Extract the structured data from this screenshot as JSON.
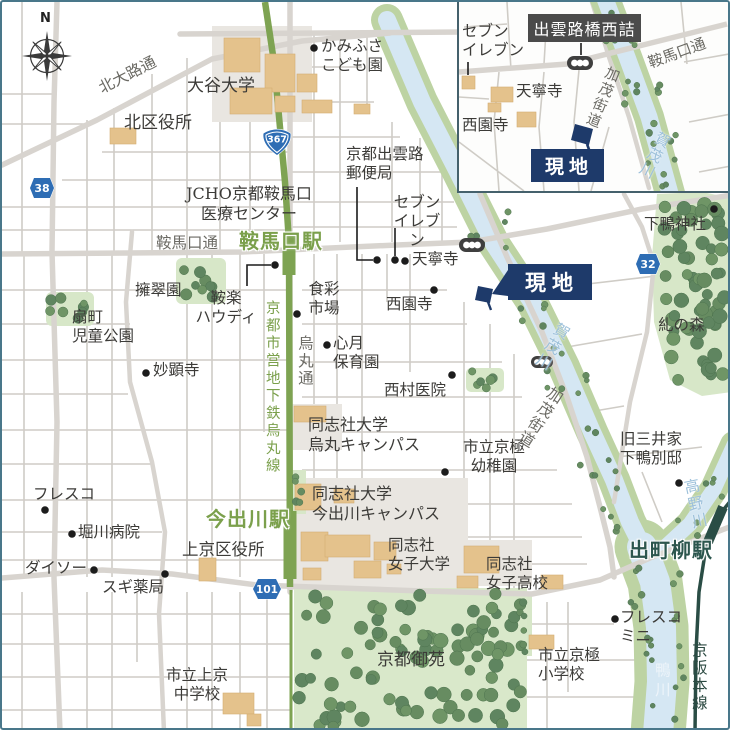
{
  "compass": {
    "north": "N"
  },
  "site": {
    "label": "現地"
  },
  "stations": {
    "kuramaguchi": "鞍馬口駅",
    "imadegawa": "今出川駅",
    "demachiyanagi": "出町柳駅"
  },
  "roads": {
    "kitaoji_dori": "北大路通",
    "kuramaguchi_dori": "鞍馬口通",
    "karasuma_dori": "烏丸通",
    "kamo_kaido": "加茂街道",
    "subway_line": "京都市営地下鉄烏丸線",
    "keihan_line": "京阪本線"
  },
  "rivers": {
    "kamogawa_upper": "賀茂川",
    "kamogawa": "鴨川",
    "takanogawa": "高野川"
  },
  "route_shields": {
    "r367": "367",
    "r38": "38",
    "r32": "32",
    "r101": "101"
  },
  "places": {
    "otani_university": "大谷大学",
    "kita_ward_office": "北区役所",
    "kamifusa_kodomoen": "かみふさ\nこども園",
    "jcho_medical_center": "JCHO京都鞍馬口\n医療センター",
    "izumoji_post_office": "京都出雲路\n郵便局",
    "seven_eleven": "セブン\nイレブン",
    "tenneiji": "天寧寺",
    "saionji": "西園寺",
    "shimogamo_shrine": "下鴨神社",
    "yosuien": "擁翠園",
    "kuraku_howdy": "鞍楽\nハウディ",
    "shokusai_ichiba": "食彩\n市場",
    "ogicho_park": "扇町\n児童公園",
    "shingetsu_hoikuen": "心月\n保育園",
    "nishimura_clinic": "西村医院",
    "myokenji": "妙顕寺",
    "doshisha_karasuma": "同志社大学\n烏丸キャンパス",
    "kyogoku_kindergarten": "市立京極\n幼稚園",
    "tadasu_no_mori": "糺の森",
    "mitsui_villa": "旧三井家\n下鴨別邸",
    "doshisha_imadegawa": "同志社大学\n今出川キャンパス",
    "fresco": "フレスコ",
    "horikawa_hospital": "堀川病院",
    "daiso": "ダイソー",
    "sugi_pharmacy": "スギ薬局",
    "kamigyo_ward_office": "上京区役所",
    "doshisha_womens_univ": "同志社\n女子大学",
    "doshisha_womens_hs": "同志社\n女子高校",
    "kyoto_gyoen": "京都御苑",
    "kamigyo_jhs": "市立上京\n中学校",
    "kyogoku_es": "市立京極\n小学校",
    "fresco_mini": "フレスコ\nミニ"
  },
  "inset": {
    "intersection_label": "出雲路橋西詰",
    "seven_eleven": "セブン\nイレブン",
    "tenneiji": "天寧寺",
    "saionji": "西園寺",
    "kuramaguchi_dori": "鞍馬口通",
    "kamo_kaido": "加茂街道",
    "kamogawa": "賀茂川",
    "site_label": "現地"
  }
}
